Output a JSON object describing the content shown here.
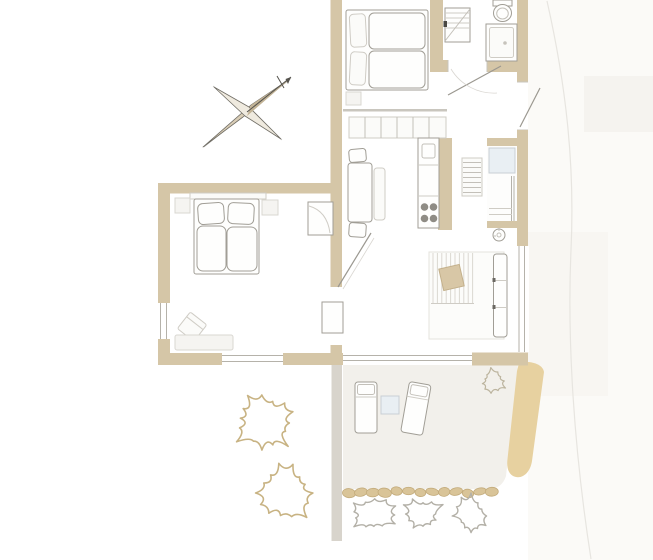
{
  "plan": {
    "type": "apartment-floor-plan",
    "rooms": [
      "bedroom-upper",
      "bathroom",
      "kitchen-dining",
      "entry-hall",
      "living-room",
      "bedroom-lower",
      "terrace",
      "garden"
    ],
    "furniture": [
      "double-bed-upper",
      "double-bed-lower",
      "kitchen-cabinet-row",
      "kitchen-counter-sink-stove",
      "dining-table",
      "dining-bench",
      "dining-chairs",
      "bathroom-vanity",
      "toilet",
      "shower",
      "entry-closet",
      "wall-shelf",
      "floor-lamp",
      "living-rug",
      "coffee-table",
      "sofa-bench",
      "wardrobe",
      "side-cabinet",
      "armchair",
      "storage-bench",
      "sun-lounger",
      "sun-lounger-rotated",
      "lounger-side-table"
    ],
    "landscape": {
      "stepping_stones": 13,
      "hedge_bushes": 3,
      "garden_bushes": 2,
      "terrace_bush": 1
    },
    "compass": "north-arrow",
    "stove_burners": 4
  },
  "palette": {
    "bg": "#ffffff",
    "wall": "#d5c6a7",
    "divider": "#d8d4cc",
    "partition": "#c9c6be",
    "glass": "#b5b2aa",
    "jamb": "#c8c5be",
    "leaf": "#9b9890",
    "line": "#a19e96",
    "lineFaint": "#cfccc5",
    "burner": "#8f8c85",
    "accentBlue": "#e9eff3",
    "accentBlueEdge": "#c9cfd4",
    "tableTan": "#d8c7a6",
    "tableTanEdge": "#c3b08b",
    "terrace": "#f2f0eb",
    "pathStrip": "#e7d1a0",
    "bushTan": "#c8b383",
    "bushTanSm": "#bcb49e",
    "bushGray": "#b3b0a7",
    "stone": "#d9c498",
    "stoneEdge": "#c3ab7b",
    "washA": "#fbfaf7",
    "washB": "#f5f3ef",
    "curve": "#e7e5e0",
    "rugEdge": "#e5e3dd",
    "rugStripe": "#dbd8d1",
    "compassDark": "#d9cdb6",
    "compassLight": "#efeadf",
    "compassEdge": "#6f6c64",
    "compassNeedle": "#55534d"
  }
}
